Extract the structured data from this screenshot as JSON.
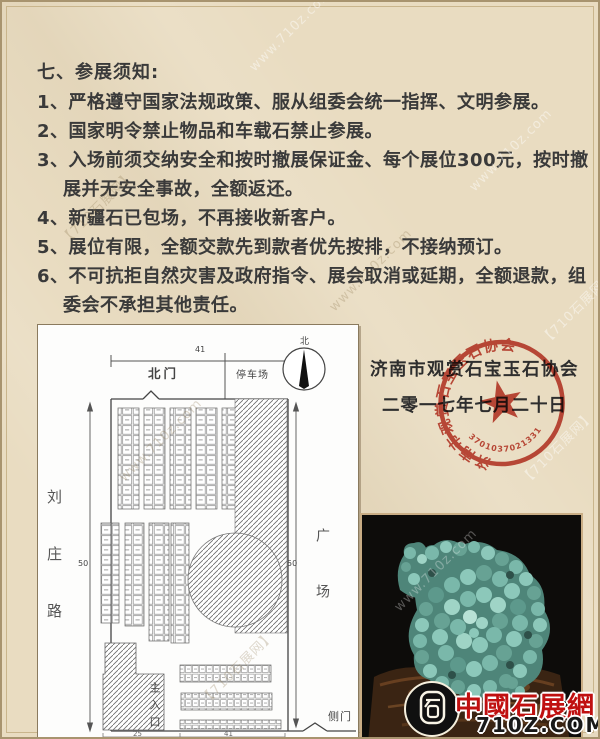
{
  "colors": {
    "background": "#e9dcc1",
    "stamp_red": "#c0392b",
    "logo_red": "#c01010",
    "plan_background": "#fdfdfc",
    "photo_background": "#0d0c0a",
    "stone_teal": "#74b3a5"
  },
  "watermarks": {
    "site": "www.710z.com",
    "name": "【710石展网】"
  },
  "notice": {
    "title": "七、参展须知:",
    "items": [
      "1、严格遵守国家法规政策、服从组委会统一指挥、文明参展。",
      "2、国家明令禁止物品和车载石禁止参展。",
      "3、入场前须交纳安全和按时撤展保证金、每个展位300元，按时撤展并无安全事故，全额返还。",
      "4、新疆石已包场，不再接收新客户。",
      "5、展位有限，全额交款先到款者优先按排，不接纳预订。",
      "6、不可抗拒自然灾害及政府指令、展会取消或延期，全额退款，组委会不承担其他责任。"
    ]
  },
  "signature": {
    "org": "济南市观赏石宝玉石协会",
    "date": "二零一七年七月二十日"
  },
  "stamp": {
    "ring_text": "济南市观赏石宝玉石协会",
    "serial": "3701037021331"
  },
  "floorplan": {
    "labels": {
      "north_gate": "北门",
      "parking": "停车场",
      "compass": "北",
      "road": "刘庄路",
      "plaza": "广场",
      "main_entrance": "主入口",
      "side_gate": "侧门",
      "dim_top": "41",
      "dim_left": "50",
      "dim_right": "50",
      "dim_bottom_left": "25",
      "dim_bottom_right": "41"
    }
  },
  "logo": {
    "title": "中國石展網",
    "domain": "710Z.COM"
  }
}
